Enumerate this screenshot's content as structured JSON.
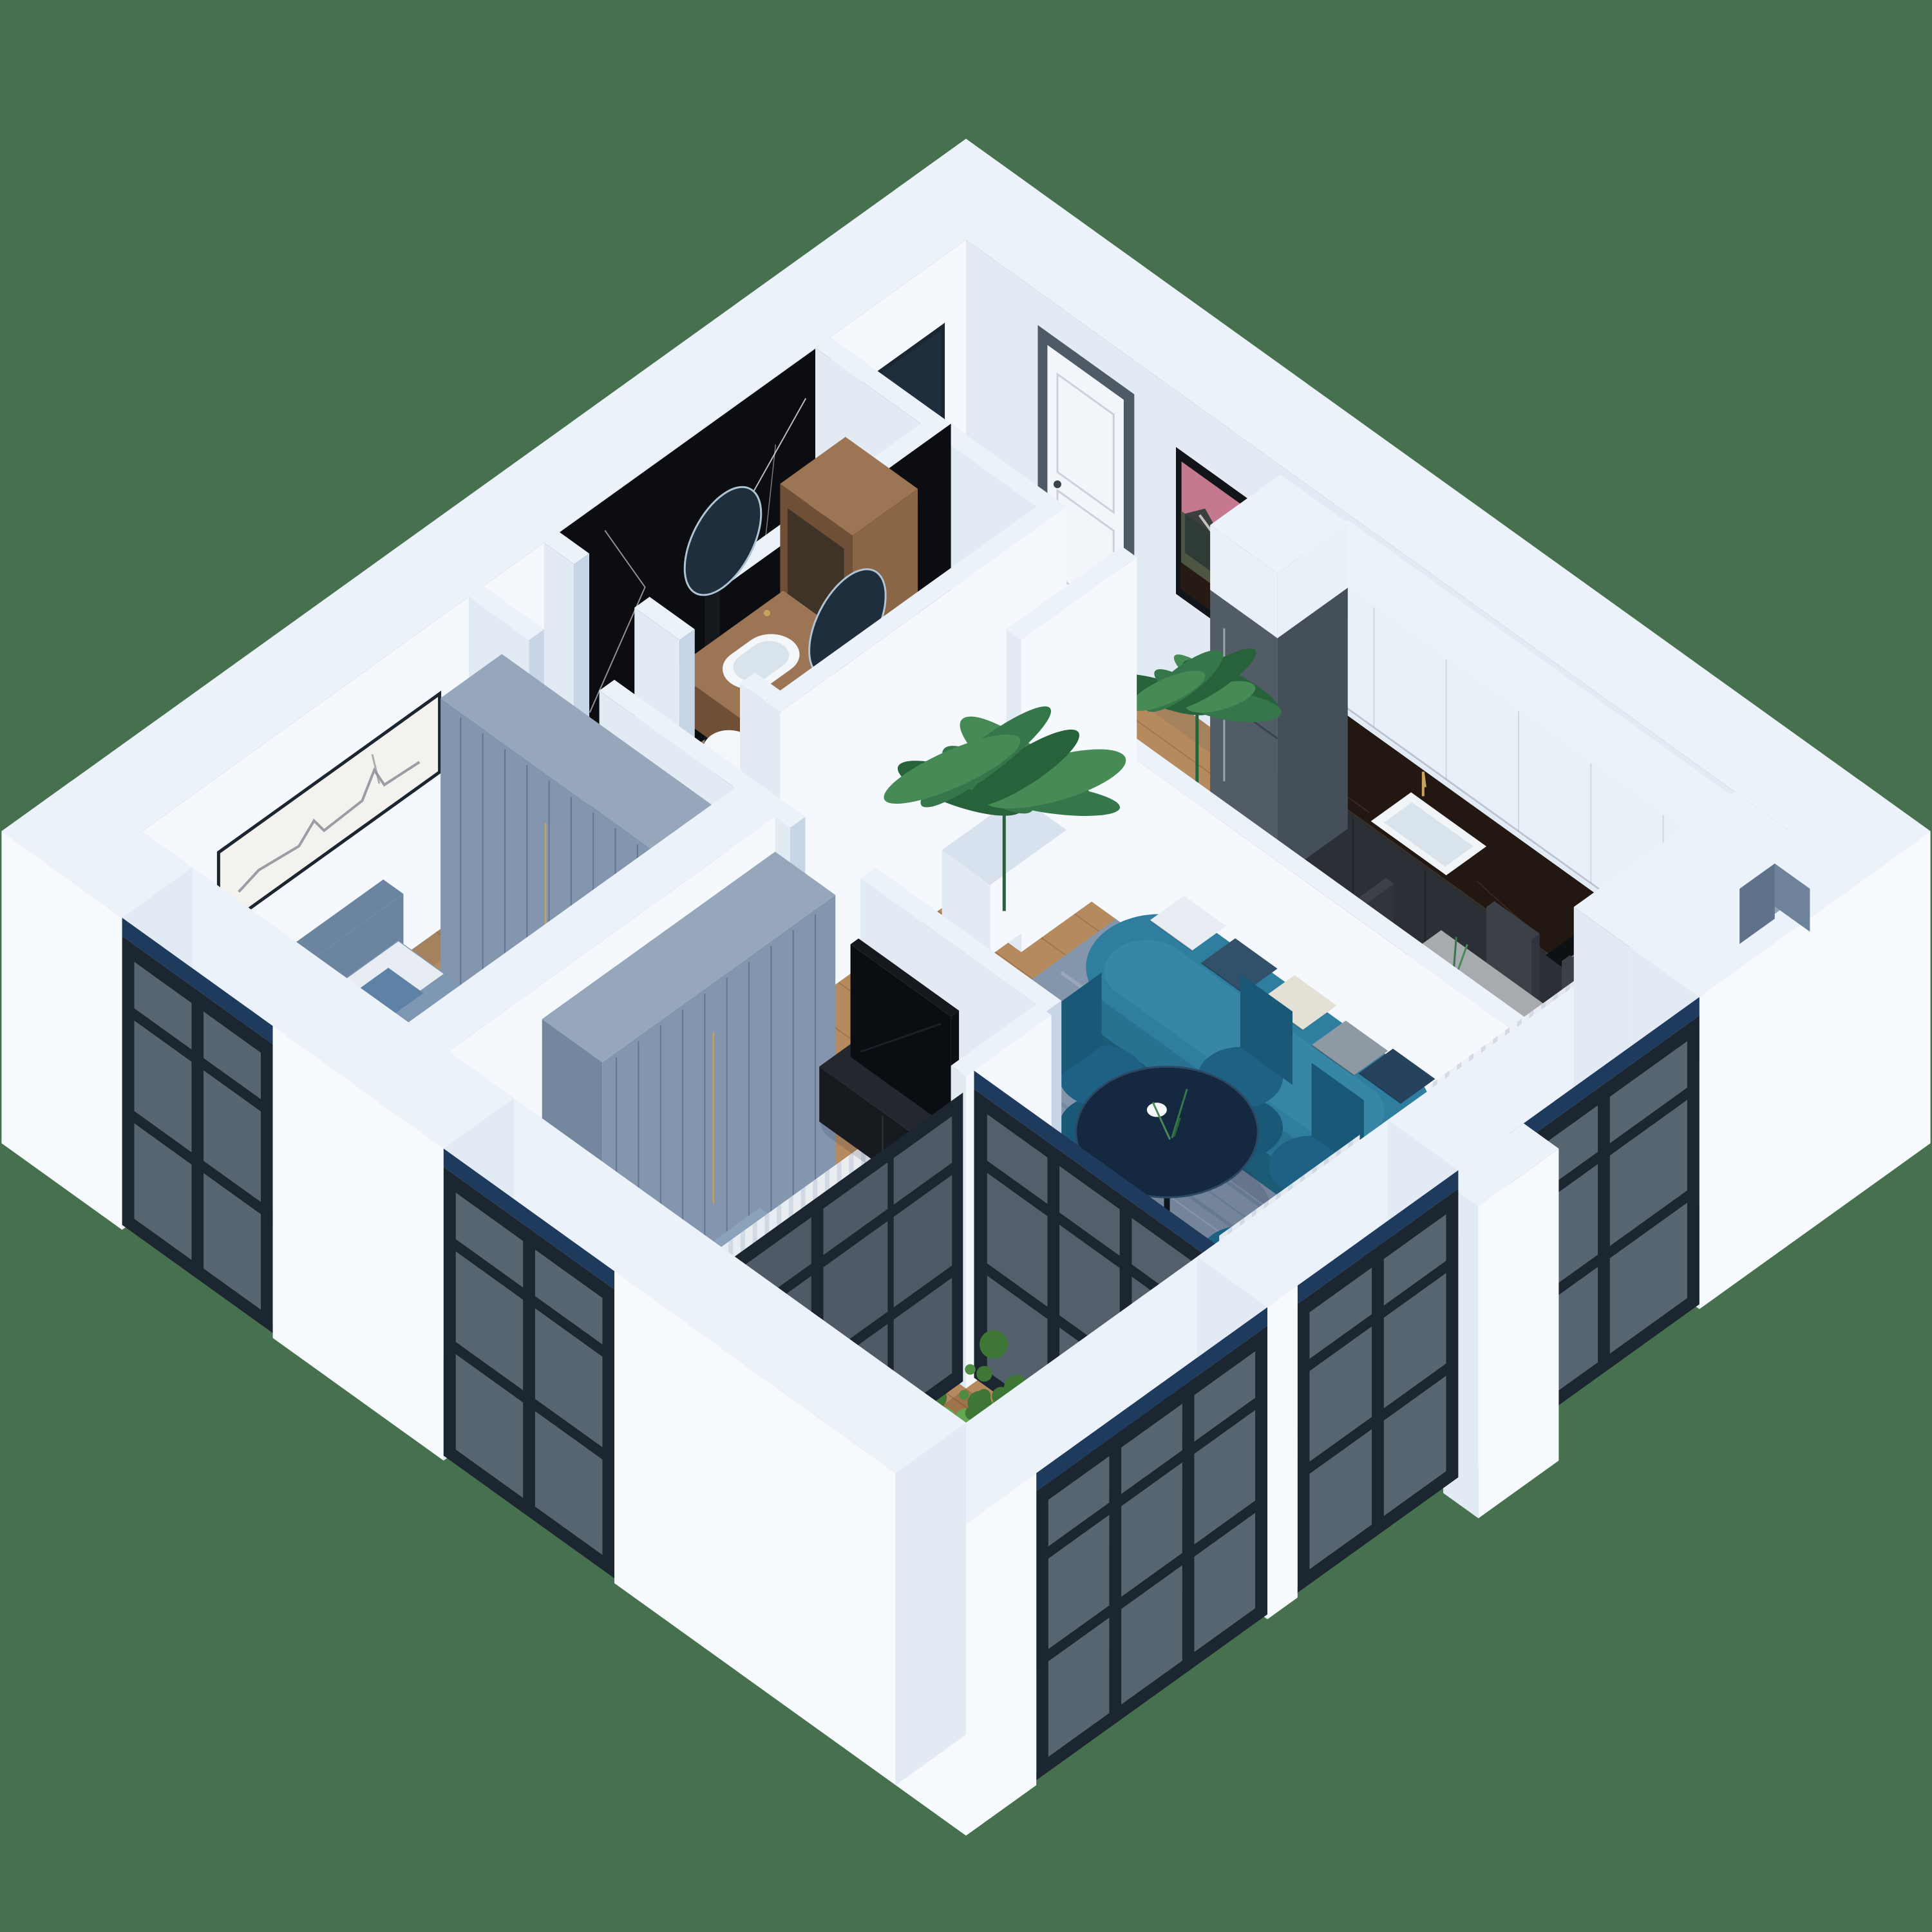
{
  "scene": {
    "kind": "isometric-3d-apartment-floorplan-render",
    "background": "#47714E",
    "rooms": [
      {
        "name": "entrance-hall",
        "items": [
          "front-door",
          "floor-mirror",
          "mountain-poster",
          "potted-plant"
        ]
      },
      {
        "name": "kitchen",
        "items": [
          "white-upper-cabinets",
          "dark-base-counter",
          "sink",
          "gas-hob",
          "fridge"
        ]
      },
      {
        "name": "dining-area",
        "items": [
          "wood-dining-table",
          "dark-chairs",
          "vase"
        ]
      },
      {
        "name": "living-room",
        "items": [
          "teal-curved-sofa",
          "pillows",
          "blue-rug",
          "round-navy-table",
          "teal-velvet-chairs",
          "tv",
          "tv-console",
          "banana-plant",
          "planter-bush"
        ]
      },
      {
        "name": "bathroom-a",
        "items": [
          "black-marble-wall",
          "wood-vanity",
          "oval-sink",
          "round-mirror",
          "tall-wood-cabinet",
          "toilet",
          "bathtub"
        ]
      },
      {
        "name": "bathroom-b",
        "items": [
          "black-marble-divider",
          "wood-vanity",
          "oval-sink",
          "round-mirror",
          "toilet"
        ]
      },
      {
        "name": "kids-bedroom",
        "items": [
          "bed-blue-bedding",
          "london-panorama-art",
          "slat-wardrobe",
          "rug",
          "armchair",
          "window"
        ]
      },
      {
        "name": "master-bedroom",
        "items": [
          "bed-channel-headboard",
          "navy-throw",
          "slat-wardrobe",
          "rug",
          "black-dresser",
          "window",
          "curtains"
        ]
      },
      {
        "name": "loggia",
        "items": [
          "glass-partition",
          "glass-door",
          "green-bushes",
          "wood-floor"
        ]
      }
    ]
  },
  "colors": {
    "bg": "#47714E",
    "wallTop": "#EBF2F9",
    "wallBright": "#F5F9FD",
    "wallMid": "#E2EAF4",
    "wallShade": "#C7D5E6",
    "facade": "#F7FAFD",
    "floor": "#B58A5E",
    "loggiaFloor": "#9E744C",
    "plank": "rgba(90,50,20,0.22)",
    "rug": "#8297AD",
    "rugDark": "#5C7591",
    "rugLight": "#B7C4D2",
    "marble": "#0B0D11",
    "marbleVein": "#E8E8E8",
    "vanityWood": "#8A6546",
    "vanityWoodDark": "#6F4F36",
    "vanityWoodTop": "#9C7654",
    "fixtureWhite": "#F4F7FA",
    "fixtureShade": "#D9E3EC",
    "mirrorGlass": "#1F2E3C",
    "mirrorShine": "#AFC4D4",
    "sofaDark": "#1C5B76",
    "sofaMid": "#277191",
    "sofaLight": "#2F7EA0",
    "sofaSeat": "#3786A6",
    "tableNavy": "#14283F",
    "tableRim": "#2C4864",
    "chairTeal": "#1E6184",
    "chairTealDark": "#1A5878",
    "woodTable": "#A8ABAD",
    "woodTableEdge": "#8E9193",
    "chairDark": "#3C4147",
    "chairDarkBack": "#31353B",
    "tvBlack": "#0A0D11",
    "consoleBlack": "#171B20",
    "counterFront": "#2B3036",
    "counterTop": "#221711",
    "counterStreak": "#4A372A",
    "counterEnd": "#343A40",
    "cabinetWhite": "#E9F0F7",
    "cabinetSeam": "#C9D6E3",
    "fridgeBody": "#525C66",
    "fridgeSide": "#454F59",
    "fridgeTop": "#6A7480",
    "frameDark": "#1C2630",
    "glass": "#B9CEDC",
    "curtain": "#EDF1F6",
    "curtainStripe": "#CBD6E2",
    "navyHeader": "#1E3A5C",
    "doorWhite": "#F2F6FA",
    "doorFrame": "#4E5A66",
    "doorOpen": "#4A5664",
    "wardrobe": "#8396AD",
    "wardrobeLine": "#5F7290",
    "wardrobeTop": "#96A7BC",
    "wardrobeEnd": "#74879F",
    "gold": "#C9A35C",
    "kidBedFrame": "#6B84A0",
    "kidDuvet": "#7E97B2",
    "kidBlanket": "#6F8BA8",
    "pillowWhite": "#E7EDF3",
    "pillowBlue": "#5E81A6",
    "masterDuvet": "#C5D2E1",
    "masterSide": "#B7C6D6",
    "masterPillow": "#DDE6EE",
    "masterHeadboard": "#D8DDE4",
    "masterThrow": "#23354A",
    "masterBlue": "#8BA2BA",
    "dresser": "#14171C",
    "lampCopper": "#C08550",
    "plantDark": "#28623A",
    "plantMid": "#35774A",
    "plantLight": "#468A56",
    "bushDark": "#3E7636",
    "bushMid": "#4E8C42",
    "bushLight": "#62A64F",
    "potBlack": "#17191C",
    "artSky": "#C4798E",
    "artMountain": "#4C5643",
    "artMountainDark": "#2C3A35",
    "artSnow": "#E8E4DE",
    "panoBg": "#F4F2EE",
    "panoInk": "#8A8F96",
    "shadow": "rgba(25,35,60,0.15)",
    "sill": "#DCE6F0",
    "threshold": "#585F68",
    "hobBlack": "#0E1114",
    "burner": "#2A2E33",
    "burnerRing": "#6E767E",
    "sinkWhite": "#F2F5F8"
  }
}
